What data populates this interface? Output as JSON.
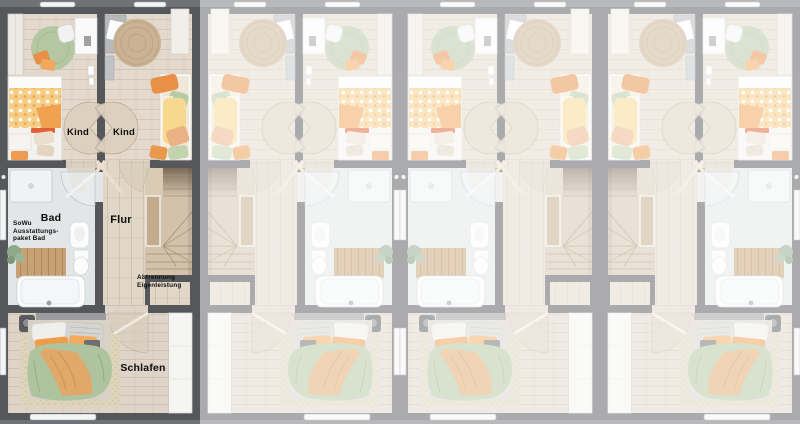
{
  "image": {
    "description": "Top-down 3D floor plan of four adjoining row-house units; first unit highlighted, units 2-4 faded",
    "units_total": 4,
    "highlighted_unit_index": 1,
    "faded_overlay_color": "#ffffff",
    "faded_overlay_opacity": 0.5
  },
  "rooms": {
    "kind_left_label": "Kind",
    "kind_right_label": "Kind",
    "bad_label": "Bad",
    "flur_label": "Flur",
    "schlafen_label": "Schlafen"
  },
  "annotations": {
    "sowu_lines": [
      "SoWu",
      "Ausstattungs-",
      "paket Bad"
    ],
    "abtrennung_lines": [
      "Abtrennung",
      "Eigenleistung"
    ]
  },
  "colors": {
    "wall": "#56575a",
    "background": "#717275",
    "kids_floor": "#e3d9cc",
    "hall_floor": "#e0d7c8",
    "stairs_wood": "#d2c2ab",
    "bath_floor": "#e3e6e7",
    "bedroom_floor": "#ded4c7",
    "rug_green": "#b4c7a2",
    "rug_jute": "#cab394",
    "duvet_green": "#aec49f",
    "duvet_orange": "#e0a96a",
    "accent_orange": "#ec9b50",
    "label_text": "#0e0e0e"
  }
}
